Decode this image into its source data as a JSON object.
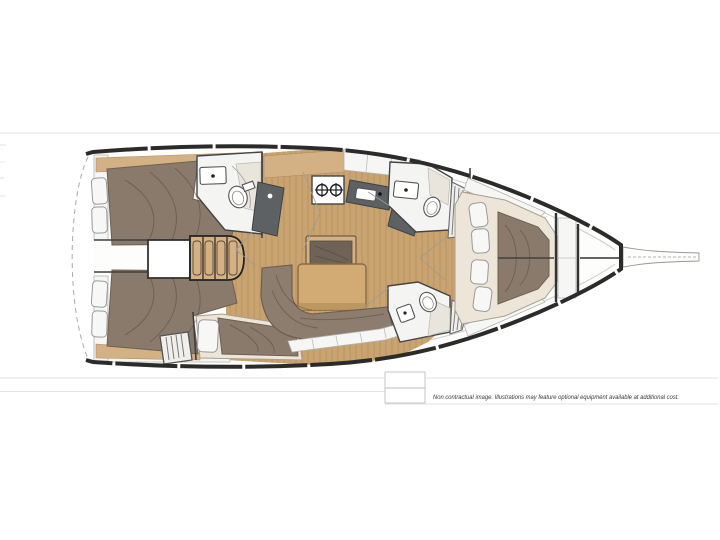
{
  "page": {
    "background": "#ffffff",
    "disclaimer_text": "Non contractual image. Illustrations may feature optional equipment available at additional cost."
  },
  "plan": {
    "subject": "sailing-yacht-interior-layout-plan",
    "orientation": "bow-right",
    "areas": [
      "aft-cabin-top",
      "aft-cabin-bottom",
      "mid-cabin",
      "companionway",
      "aft-heads",
      "galley",
      "nav-station",
      "saloon",
      "forward-heads-top",
      "forward-heads-bottom",
      "forward-cabin",
      "anchor-locker",
      "bowsprit"
    ]
  },
  "colors": {
    "hull_outline": "#2b2b2b",
    "wood_floor": "#c9a470",
    "wood_plank_line": "#a9854f",
    "wood_trim": "#d3b184",
    "bed_fabric": "#8a7a6b",
    "sofa_fabric": "#8d7d6f",
    "counter_dark": "#5d6164",
    "table_wood": "#d2ab74",
    "cushion_white": "#f7f7f5",
    "room_floor": "#f4f4f2",
    "faint_line": "#e3e3e3"
  }
}
